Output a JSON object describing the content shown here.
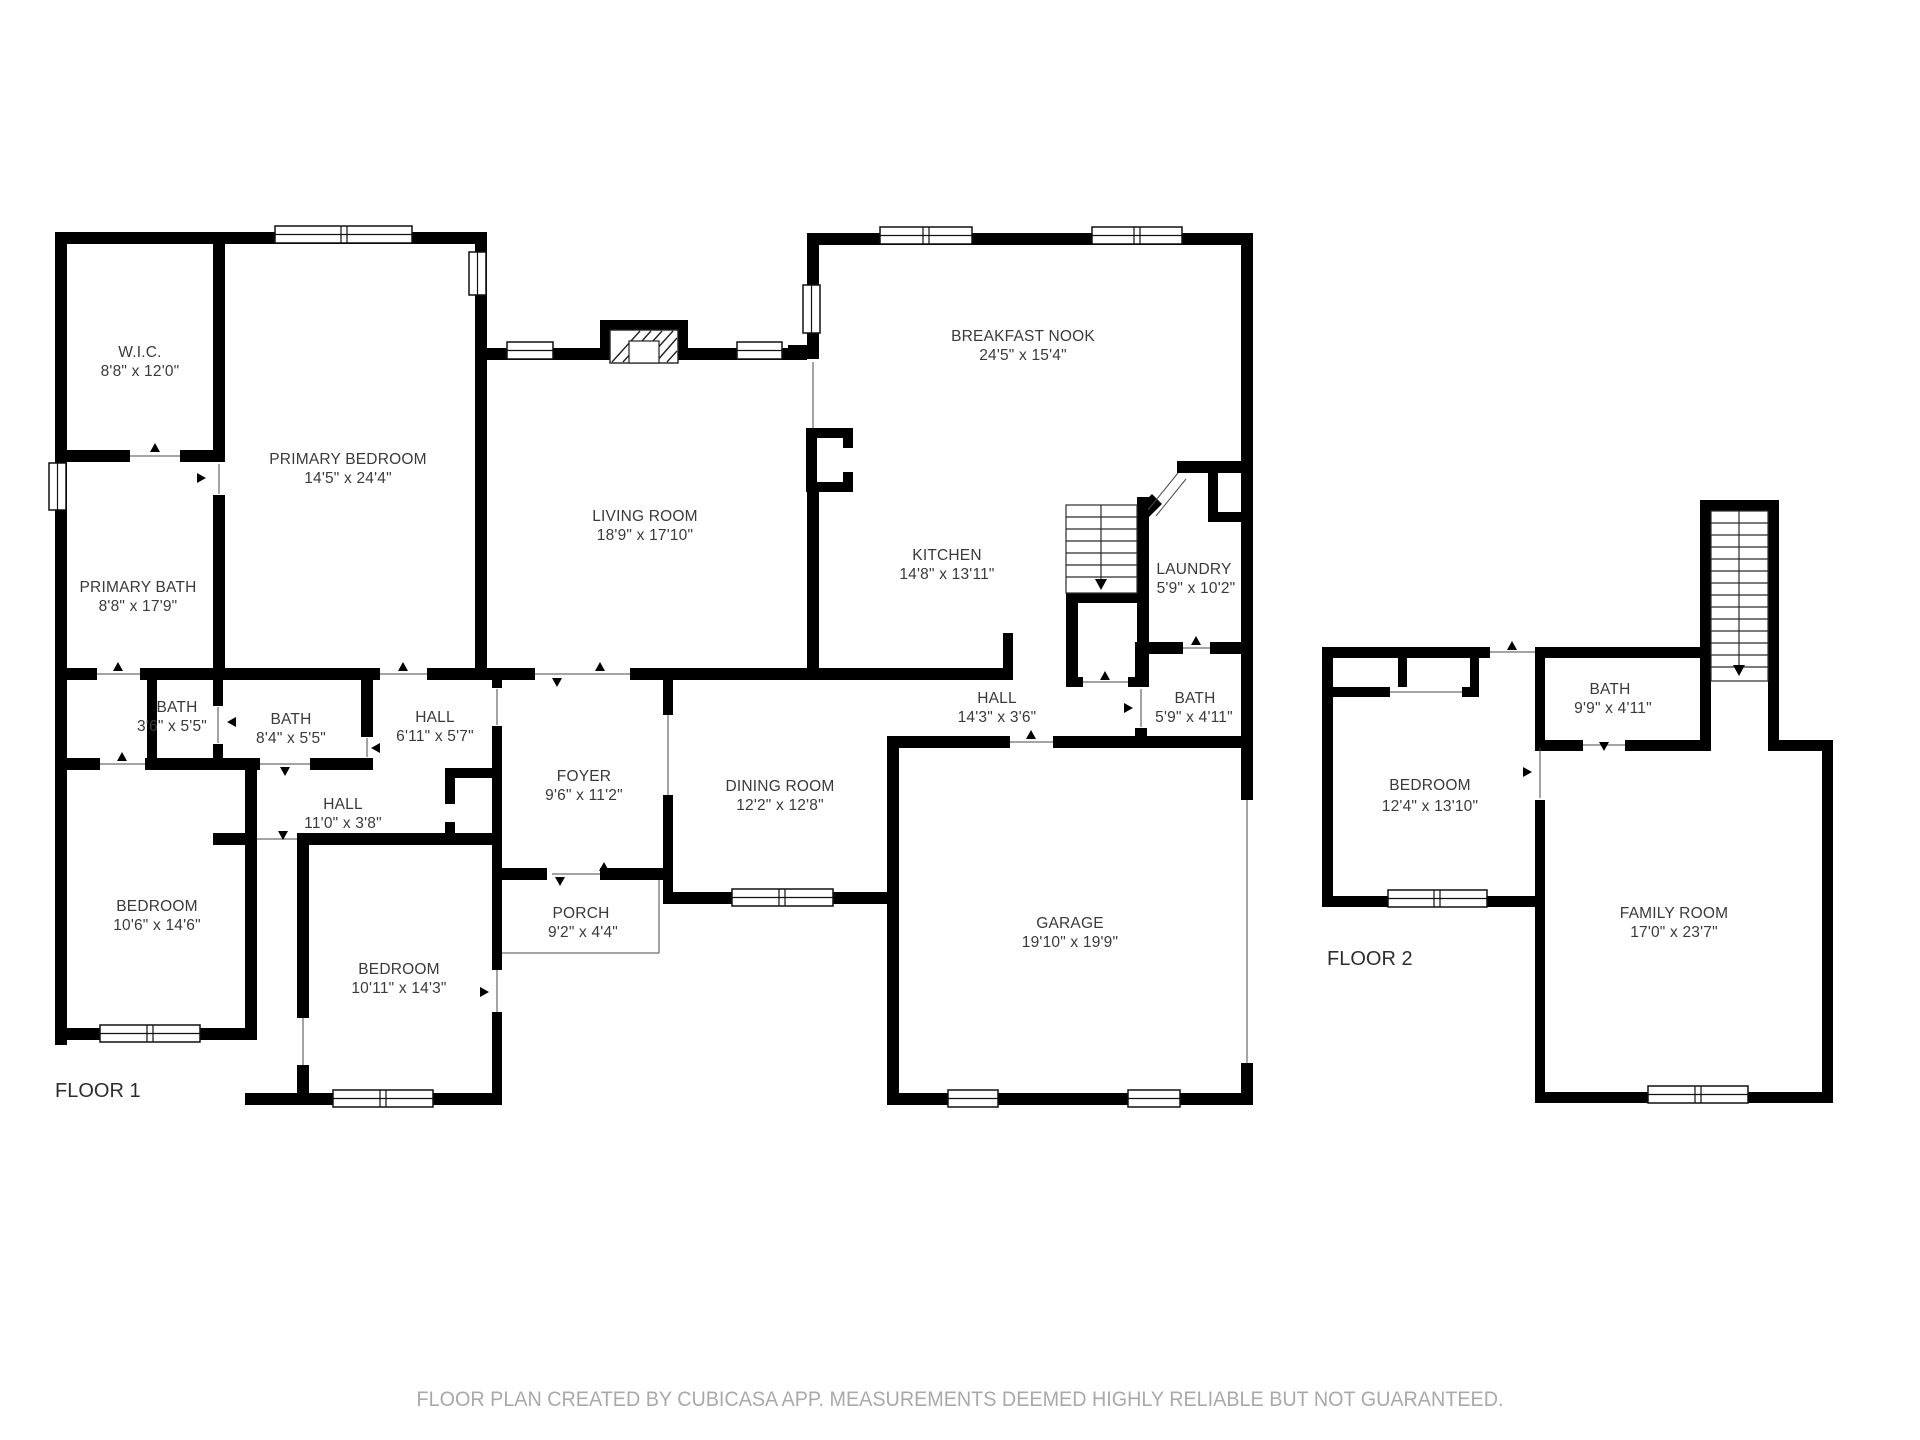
{
  "floor1": {
    "label": "FLOOR 1",
    "rooms": [
      {
        "name": "W.I.C.",
        "dims": "8'8\" x 12'0\""
      },
      {
        "name": "PRIMARY BEDROOM",
        "dims": "14'5\" x 24'4\""
      },
      {
        "name": "PRIMARY BATH",
        "dims": "8'8\" x 17'9\""
      },
      {
        "name": "BATH",
        "dims": "3'6\" x 5'5\""
      },
      {
        "name": "BATH",
        "dims": "8'4\" x 5'5\""
      },
      {
        "name": "HALL",
        "dims": "6'11\" x 5'7\""
      },
      {
        "name": "HALL",
        "dims": "11'0\" x 3'8\""
      },
      {
        "name": "BEDROOM",
        "dims": "10'6\" x 14'6\""
      },
      {
        "name": "BEDROOM",
        "dims": "10'11\" x 14'3\""
      },
      {
        "name": "FOYER",
        "dims": "9'6\" x 11'2\""
      },
      {
        "name": "PORCH",
        "dims": "9'2\" x 4'4\""
      },
      {
        "name": "DINING ROOM",
        "dims": "12'2\" x 12'8\""
      },
      {
        "name": "LIVING ROOM",
        "dims": "18'9\" x 17'10\""
      },
      {
        "name": "BREAKFAST NOOK",
        "dims": "24'5\" x 15'4\""
      },
      {
        "name": "KITCHEN",
        "dims": "14'8\" x 13'11\""
      },
      {
        "name": "HALL",
        "dims": "14'3\" x 3'6\""
      },
      {
        "name": "LAUNDRY",
        "dims": "5'9\" x 10'2\""
      },
      {
        "name": "BATH",
        "dims": "5'9\" x 4'11\""
      },
      {
        "name": "GARAGE",
        "dims": "19'10\" x 19'9\""
      }
    ]
  },
  "floor2": {
    "label": "FLOOR 2",
    "rooms": [
      {
        "name": "BATH",
        "dims": "9'9\" x 4'11\""
      },
      {
        "name": "BEDROOM",
        "dims": "12'4\" x 13'10\""
      },
      {
        "name": "FAMILY ROOM",
        "dims": "17'0\" x 23'7\""
      }
    ]
  },
  "footer": {
    "disclaimer": "FLOOR PLAN CREATED BY CUBICASA APP. MEASUREMENTS DEEMED HIGHLY RELIABLE BUT NOT GUARANTEED."
  },
  "colors": {
    "wall": "#000000",
    "label_text": "#3a3a3a",
    "floor_label_text": "#2e2e2e",
    "disclaimer_text": "#a9a9a9",
    "background": "#ffffff"
  }
}
